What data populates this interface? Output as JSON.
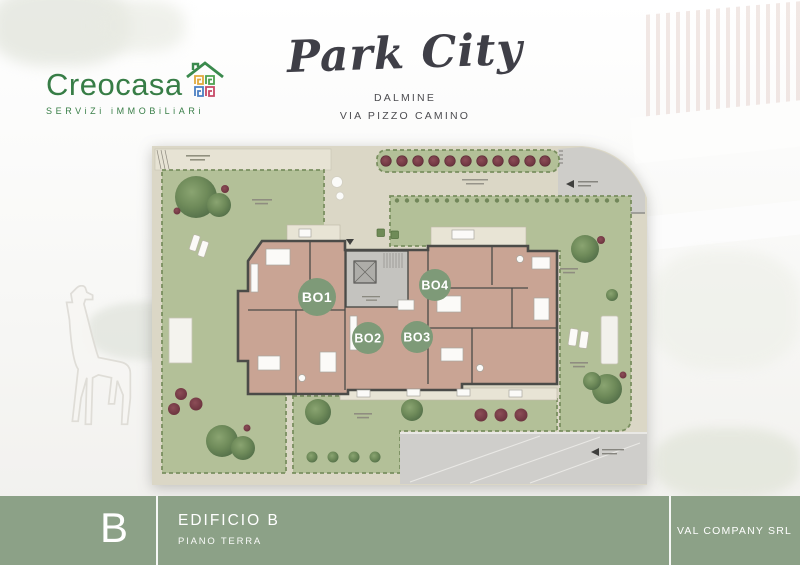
{
  "header": {
    "logo": {
      "name": "Creocasa",
      "tagline": "SERViZi iMMOBiLiARi",
      "brand_color": "#377d46",
      "icon": "house-mosaic-icon",
      "icon_colors": [
        "#e1a93c",
        "#4ba04e",
        "#4b7fc3",
        "#c74866"
      ]
    },
    "title": "Park City",
    "location_line1": "DALMINE",
    "location_line2": "VIA PIZZO CAMINO"
  },
  "plan": {
    "type": "site-floor-plan",
    "units": [
      {
        "id": "BO1"
      },
      {
        "id": "BO2"
      },
      {
        "id": "BO3"
      },
      {
        "id": "BO4"
      }
    ],
    "unit_label_color": "#7e9a78",
    "lawn_color": "#b3c098",
    "path_color": "#dbd7c6",
    "building_floor_color": "#c9a494",
    "wall_color": "#4b4b48",
    "accent_tree_color": "#7b414b"
  },
  "footer": {
    "building_letter": "B",
    "building_name": "EDIFICIO B",
    "floor": "PIANO TERRA",
    "company": "VAL COMPANY SRL",
    "bar_color": "#879e82"
  }
}
